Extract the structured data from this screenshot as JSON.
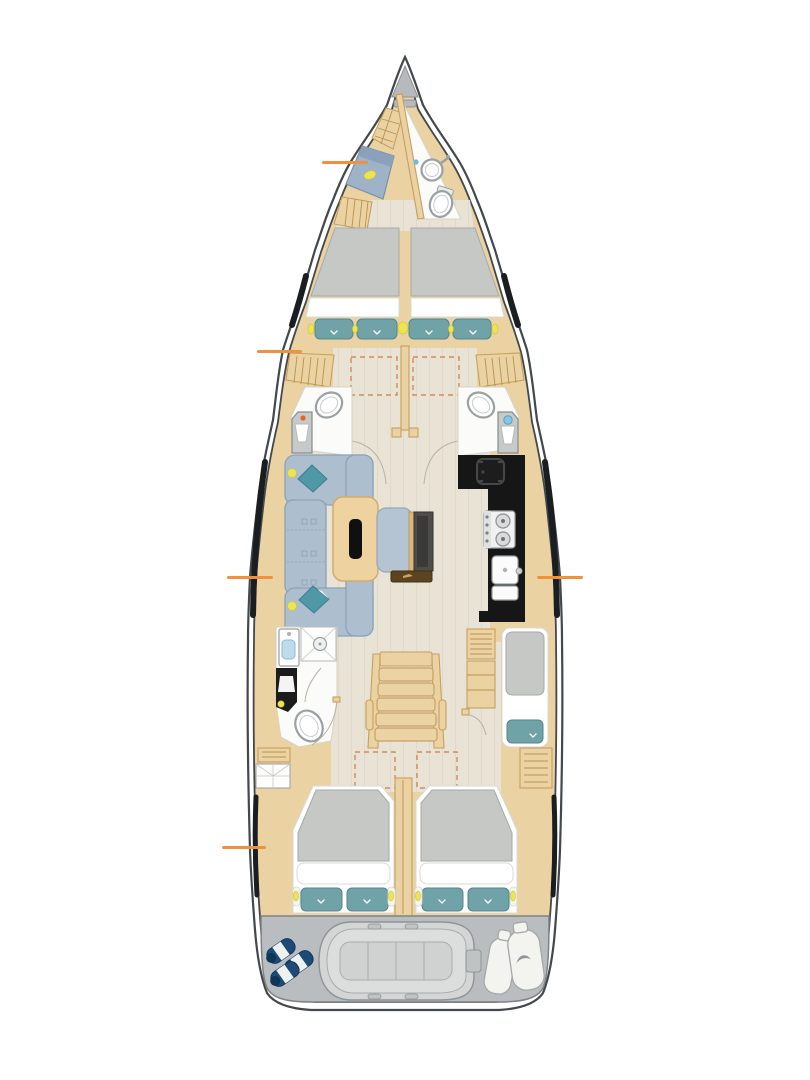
{
  "meta": {
    "figure": "sailing-yacht-interior-deck-plan",
    "width": 810,
    "height": 1080,
    "background": "#ffffff"
  },
  "colors": {
    "hull": "#43484c",
    "wood": "#ead2a2",
    "woodEdge": "#c79f5e",
    "woodSlat": "#b9914f",
    "floor": "#e9e3d6",
    "floorLine": "#d9d2c2",
    "room": "#fbfbf9",
    "roomEdge": "#d9d3c5",
    "fixture": "#9aa0a3",
    "fixtureInner": "#c6cacb",
    "mattress": "#c5c8c5",
    "mattressEdge": "#a6aaa6",
    "sheet": "#ffffff",
    "sheetEdge": "#d8dad6",
    "pillow": "#6fa3a8",
    "pillowEdge": "#54868d",
    "sofa": "#adbfce",
    "sofaEdge": "#8aa2b7",
    "throw": "#4f98a6",
    "throwEdge": "#3c7f8d",
    "yellow": "#ece54f",
    "galley": "#161616",
    "galleyDetail": "#474747",
    "deck": "#babdbf",
    "deckEdge": "#7e8386",
    "dinghy": "#d4d6d6",
    "dinghyEdge": "#8f9496",
    "navy": "#1d4b78",
    "navyDark": "#10355a",
    "marker": "#f0913d",
    "hatch": "#cf7a45",
    "berth": "#9fb3c8",
    "berthEdge": "#7b90a8",
    "blue": "#86c6e4",
    "arc": "#b9b2a2",
    "window": "#1b1e20",
    "anchor": "#b7babc",
    "steel": "#c6cac9",
    "tableWood": "#eed2a0",
    "tableEdge": "#d3ab6c",
    "tv": "#4e4d4a",
    "shelfDark": "#5c4423"
  },
  "hotspots": [
    {
      "id": "crew-cabin",
      "x": 322,
      "y": 161,
      "length": 46,
      "side": "port"
    },
    {
      "id": "forward-cabin",
      "x": 257,
      "y": 350,
      "length": 45,
      "side": "port"
    },
    {
      "id": "salon",
      "x": 227,
      "y": 576,
      "length": 46,
      "side": "port"
    },
    {
      "id": "galley",
      "x": 537,
      "y": 576,
      "length": 46,
      "side": "starboard"
    },
    {
      "id": "aft-cabin",
      "x": 222,
      "y": 846,
      "length": 44,
      "side": "port"
    }
  ],
  "regions_bow_to_stern": [
    "anchor-locker",
    "crew-cabin",
    "bow-head",
    "forward-cabin",
    "port-head",
    "starboard-head",
    "salon",
    "galley",
    "aft-bathroom",
    "companionway-stairs",
    "single-berth-cabin",
    "aft-cabin-port",
    "aft-cabin-starboard",
    "transom-garage"
  ]
}
